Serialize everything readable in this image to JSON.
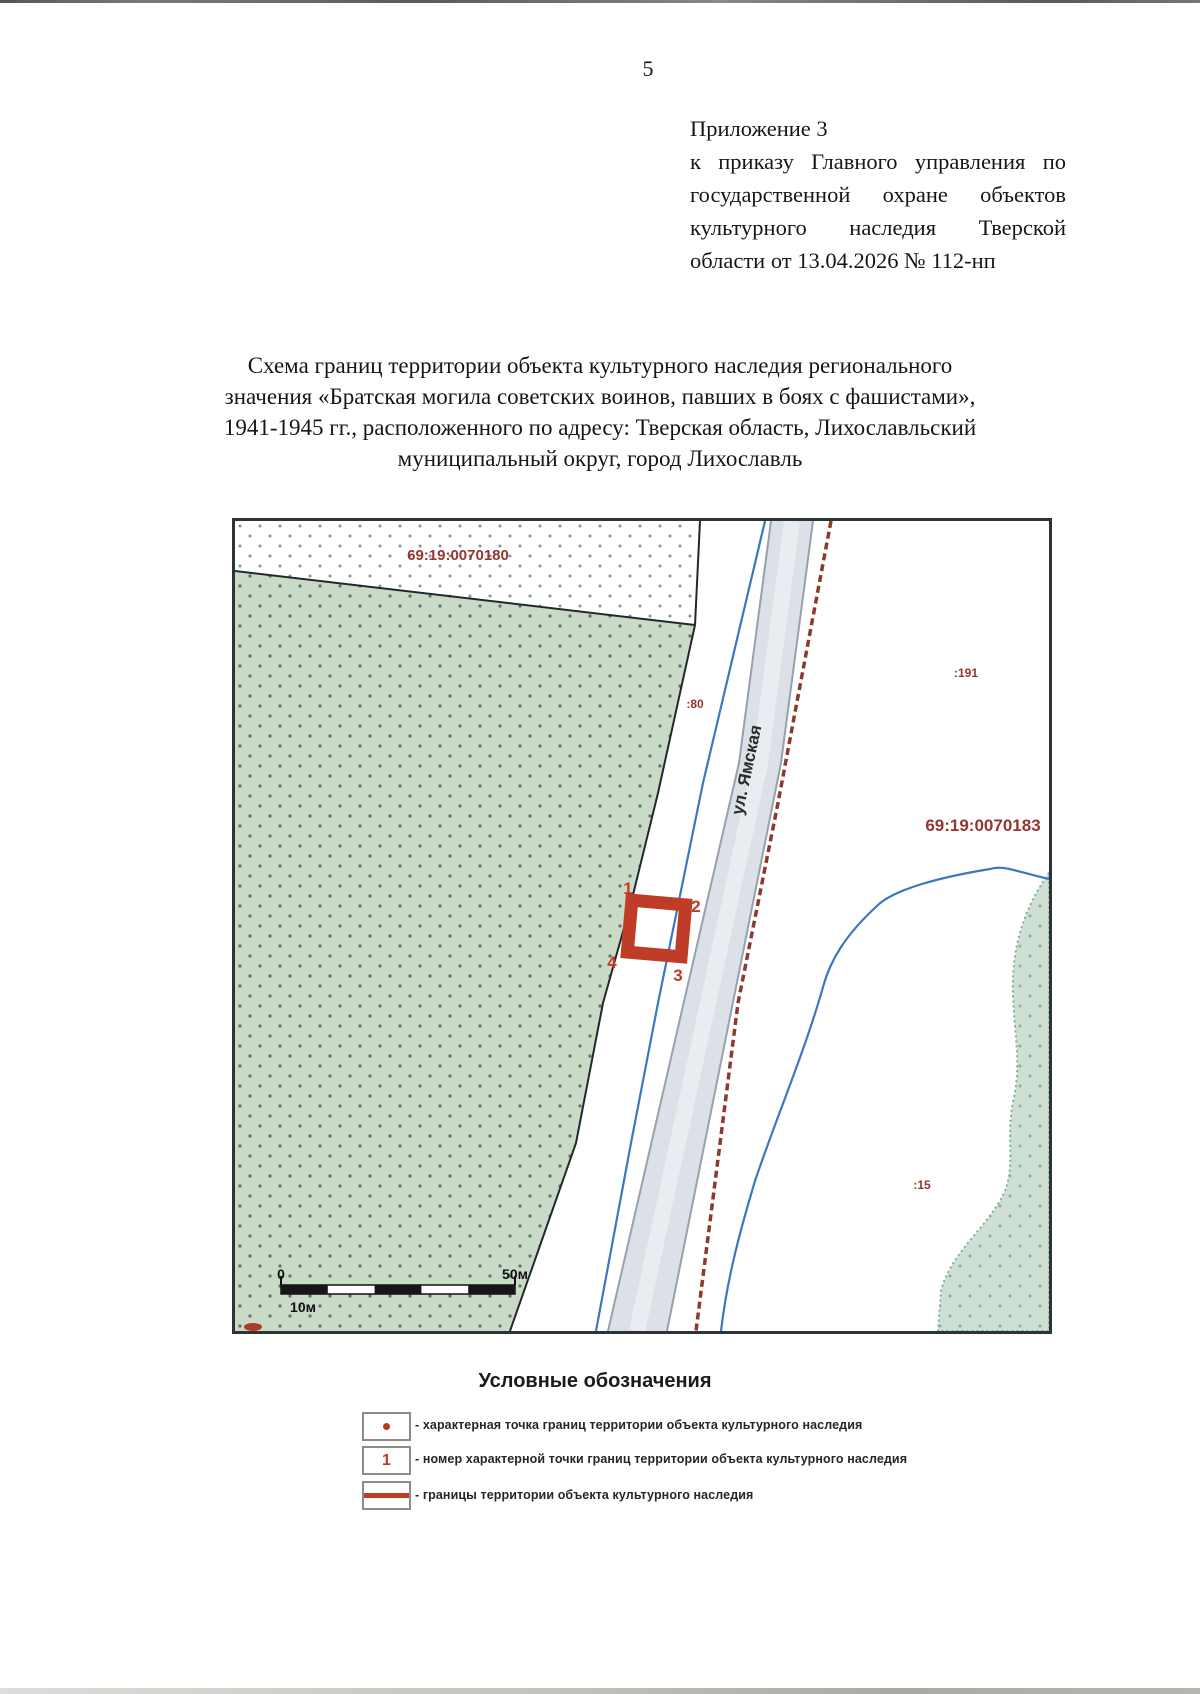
{
  "page": {
    "number": "5",
    "appendix_lines": [
      "Приложение 3",
      "к приказу Главного управления по",
      "государственной охране объектов",
      "культурного наследия Тверской",
      "области от 13.04.2026 № 112-нп"
    ],
    "title_lines": [
      "Схема границ территории объекта культурного наследия регионального",
      "значения «Братская могила советских воинов, павших в боях с фашистами»,",
      "1941-1945 гг., расположенного по адресу: Тверская область, Лихославльский",
      "муниципальный округ, город Лихославль"
    ]
  },
  "map": {
    "labels": {
      "cadastral_top": "69:19:0070180",
      "cadastral_right": "69:19:0070183",
      "parcel_80": ":80",
      "parcel_191": ":191",
      "parcel_15": ":15",
      "street": "ул. Ямская"
    },
    "points": [
      "1",
      "2",
      "3",
      "4"
    ],
    "scale": {
      "zero": "0",
      "fifty": "50м",
      "ten": "10м"
    },
    "colors": {
      "boundary_red": "#bf3d27",
      "point_label_red": "#c03a26",
      "cadastral_label": "#943530",
      "water_blue": "#3c78c0",
      "fence_dashed": "#8c3a2c",
      "green_parcel": "#c9dbc7",
      "road_fill": "#dce1e8"
    }
  },
  "legend": {
    "title": "Условные обозначения",
    "items": [
      {
        "symbol": "point-dot",
        "text": "- характерная точка границ территории объекта культурного наследия"
      },
      {
        "symbol": "point-number",
        "symbol_label": "1",
        "text": "- номер характерной точки границ территории объекта культурного наследия"
      },
      {
        "symbol": "boundary-line",
        "text": "- границы территории объекта культурного наследия"
      }
    ]
  }
}
